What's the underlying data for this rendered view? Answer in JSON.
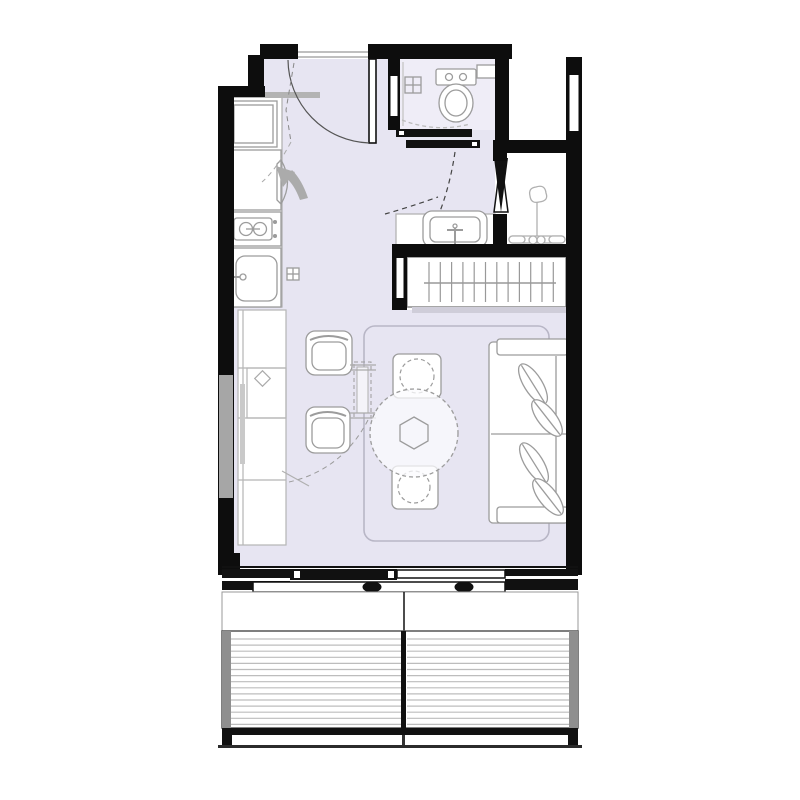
{
  "document": {
    "type": "architectural-floor-plan",
    "description": "studio-apartment-plan-top-view",
    "text_labels": []
  },
  "colors": {
    "background": "#ffffff",
    "wall": "#0d0d0d",
    "floor_main": "#e7e5f2",
    "floor_bath": "#efedf7",
    "fixture_outline": "#9c9c9c",
    "fixture_light": "#b8b8b8",
    "counter_outline": "#b3b3b3",
    "threshold_gray": "#b3b3b3",
    "window_gray": "#a6a6a6",
    "shadow": "#cfcdd9",
    "rug_outline": "#b8b6c6",
    "louver_line": "#bdbdbd",
    "balcony_post": "#8f8f8f",
    "ground_line": "#2b2b2b",
    "arrow_gray": "#ababab",
    "door_arc": "#555555"
  },
  "zones": {
    "kitchen": {
      "fixtures": [
        "fridge",
        "cabinet",
        "cooktop",
        "kitchen-sink",
        "floor-drain"
      ]
    },
    "entry": {
      "fixtures": [
        "entry-door",
        "door-swing-arc",
        "threshold",
        "entry-arrow"
      ]
    },
    "bathroom": {
      "fixtures": [
        "toilet",
        "floor-drain",
        "wall-niche",
        "sliding-door"
      ]
    },
    "hallway": {
      "fixtures": [
        "vanity-sink",
        "swing-path"
      ]
    },
    "utility_room": {
      "fixtures": [
        "bifold-door",
        "drying-rack"
      ]
    },
    "wardrobe": {
      "fixtures": [
        "hanging-rail",
        "hanger-ticks"
      ]
    },
    "living_room": {
      "fixtures": [
        "rug",
        "round-table",
        "table-vase",
        "chair",
        "chair",
        "stool",
        "stool",
        "tv-panel",
        "bed-sofa",
        "pillows",
        "desk-counter",
        "side-window"
      ]
    },
    "balcony": {
      "fixtures": [
        "sliding-glass-doors",
        "door-handles",
        "balcony-floor",
        "louver-deck",
        "railing"
      ]
    }
  },
  "counts": {
    "wardrobe_hanger_ticks": 12,
    "louver_lines": 15,
    "pillow_leaves": 4
  }
}
